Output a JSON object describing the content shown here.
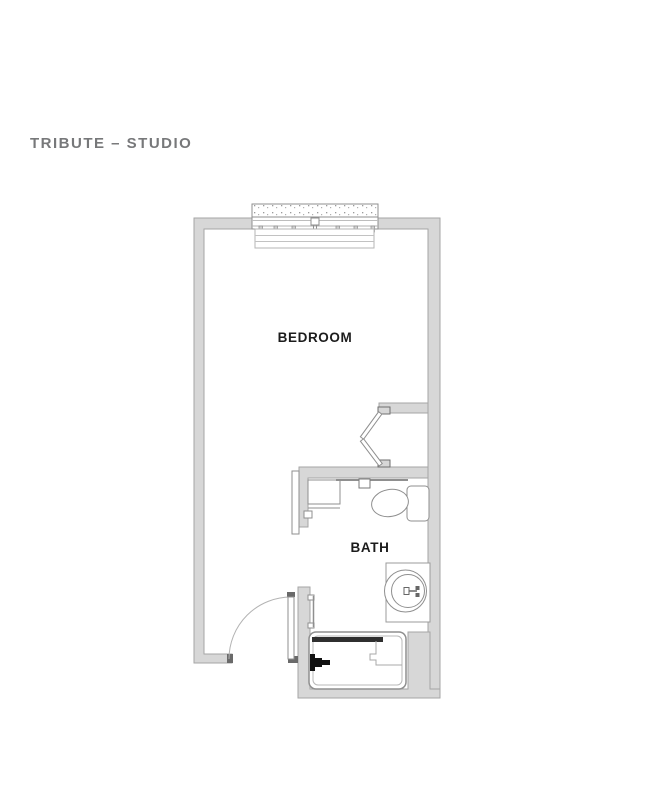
{
  "title": "TRIBUTE – STUDIO",
  "plan": {
    "rooms": [
      {
        "name": "BEDROOM"
      },
      {
        "name": "BATH"
      }
    ],
    "fixtures": [
      "window",
      "bifold-closet-doors",
      "entry-door",
      "sliding-bath-door",
      "shelf-unit",
      "grab-bar",
      "towel-bar",
      "toilet",
      "vanity-sink",
      "shower"
    ],
    "colors": {
      "wall_fill": "#d7d7d7",
      "wall_outline": "#a6a6a6",
      "fixture_line": "#8f8f8f",
      "accent_dark": "#2f2f2f",
      "cap_dark": "#6a6a6a",
      "label_text": "#1c1c1c",
      "title_text": "#77787a",
      "page_bg": "#ffffff"
    }
  }
}
